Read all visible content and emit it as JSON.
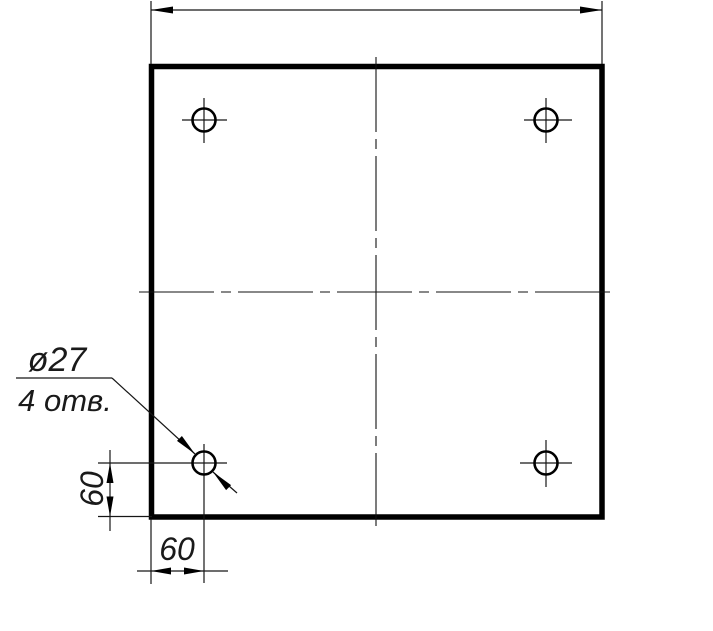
{
  "drawing": {
    "kind": "engineering-drawing",
    "labels": {
      "hole_diameter": "ø27",
      "hole_count": "4 отв.",
      "offset_vertical": "60",
      "offset_horizontal": "60"
    },
    "dimensions": {
      "hole_diameter_value": 27,
      "hole_count_value": 4,
      "hole_offset_from_left_edge": 60,
      "hole_offset_from_bottom_edge": 60
    },
    "colors": {
      "line": "#000000",
      "background": "#ffffff"
    }
  }
}
